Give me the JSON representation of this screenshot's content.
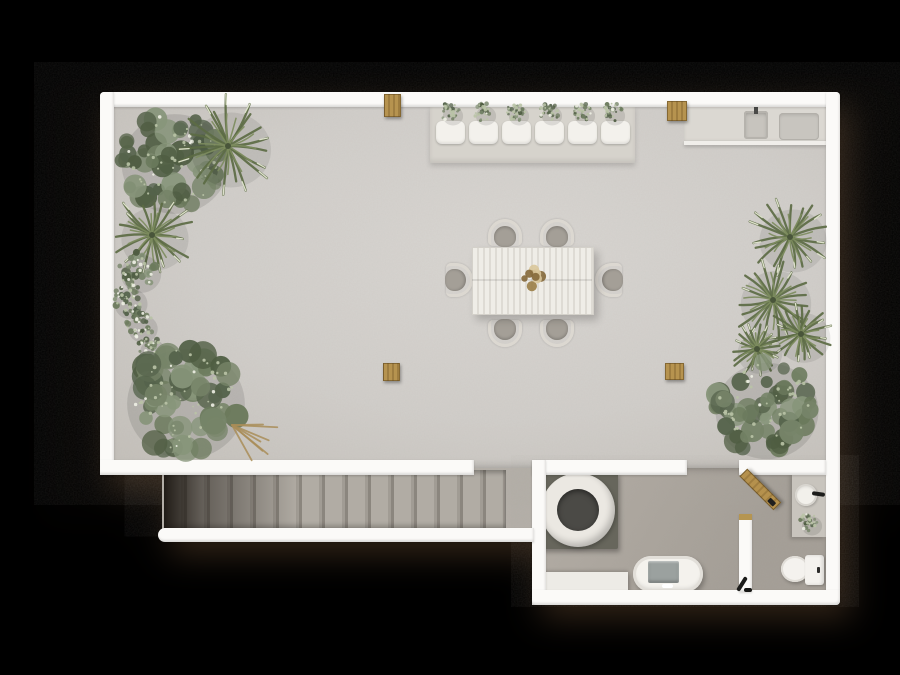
{
  "scene": {
    "type": "architectural floor plan, top-down 3D render",
    "background_color": "#000000",
    "no_visible_text": true,
    "areas": [
      {
        "name": "rooftop-terrace",
        "floor_color": "#d1cec9",
        "objects": [
          "outdoor-kitchen-counter",
          "kitchen-sink",
          "kitchen-faucet",
          "kitchen-grill",
          "wood-wall-box-left",
          "wood-wall-box-right",
          "planter-bench",
          "bench-cushions",
          "bench-plants",
          "dining-table",
          "dining-chairs",
          "table-centerpiece",
          "wood-stool-left",
          "wood-stool-right",
          "leafy-tree-top-left",
          "palm-top-left",
          "yucca-left",
          "flowering-vine-left",
          "leafy-tree-bottom-left",
          "fallen-branches",
          "palm-right-upper",
          "palm-right-middle",
          "palm-right-lower",
          "yucca-right",
          "leafy-tree-bottom-right"
        ],
        "counts": {
          "bench_cushions": 6,
          "dining_chairs": 6
        }
      },
      {
        "name": "staircase",
        "floor_color": "#a9a49c",
        "objects": [
          "straight-stair-flight-descending-left"
        ],
        "counts": {
          "treads": 15
        }
      },
      {
        "name": "spa-room",
        "floor_color": "#aba49c",
        "objects": [
          "round-soaking-tub",
          "dark-tub-mat",
          "oval-freestanding-bathtub",
          "bench-ledge"
        ]
      },
      {
        "name": "bathroom",
        "floor_color": "#aba49c",
        "objects": [
          "vanity-counter",
          "round-basin",
          "black-faucet",
          "potted-plant",
          "toilet",
          "open-wooden-door"
        ]
      }
    ],
    "palette": {
      "wall": "#fbfaf8",
      "terrace_floor": "#d1cec9",
      "annex_floor": "#aca69e",
      "stair_tread": "#a8a39b",
      "wood": "#b2924f",
      "plant_dark": "#55634b",
      "plant_light": "#87957a",
      "palm_tip": "#dde1cb",
      "tub_mat": "#66655c",
      "tub_inner": "#4b4a46",
      "cushion": "#f3f1ec",
      "fixture_white": "#f4f2ee",
      "shadow_cast": "#2a1f14"
    }
  }
}
